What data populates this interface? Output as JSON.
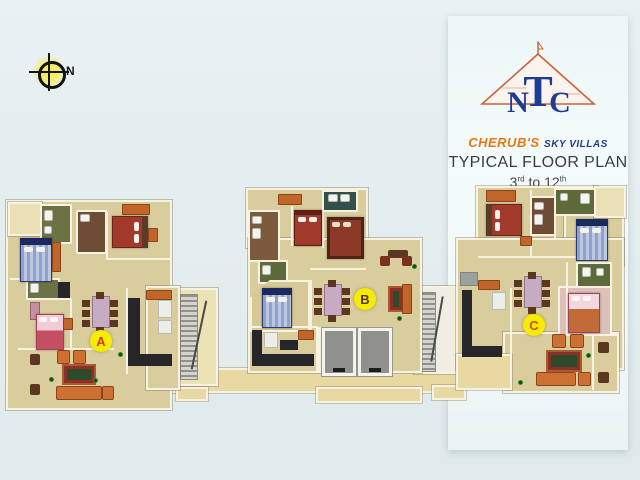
{
  "header": {
    "logo_letters": [
      "N",
      "T",
      "C"
    ],
    "brand_primary": "CHERUB'S",
    "brand_secondary": "SKY VILLAS",
    "title": "TYPICAL FLOOR PLAN",
    "range": {
      "from": "3",
      "from_ord": "rd",
      "connector": "to",
      "to": "12",
      "to_ord": "th"
    }
  },
  "compass": {
    "label": "N"
  },
  "units": [
    {
      "label": "A",
      "letter_color": "#d23c14"
    },
    {
      "label": "B",
      "letter_color": "#5a3414"
    },
    {
      "label": "C",
      "letter_color": "#d2500f"
    }
  ],
  "badge_bg": "#f6ec00",
  "palette": {
    "background": "#e3edee",
    "panel": "#f2f9fa",
    "logo_blue": "#1e3c94",
    "logo_triangle_orange": "#c8643c",
    "brand_orange": "#e8770f",
    "title_gray": "#3c3c3e",
    "floor_tan": "#d9cd9e",
    "corridor_tan": "#e8d9a2",
    "wall_cream": "#f8f2e1",
    "bath_olive": "#6d7245",
    "bath_green": "#5d6b3a",
    "bath_teal": "#32514a",
    "bath_brown": "#6f4c36",
    "kitchen_counter_dark": "#26262a",
    "furniture_orange": "#c1662a",
    "bed_blue": "#8fa2cc",
    "bed_red": "#a23a2c",
    "bed_maroon": "#8c3a28",
    "bed_pink": "#f0cdd6",
    "dining_table_mauve": "#c7abc2",
    "badge_yellow": "#f6ec00"
  }
}
